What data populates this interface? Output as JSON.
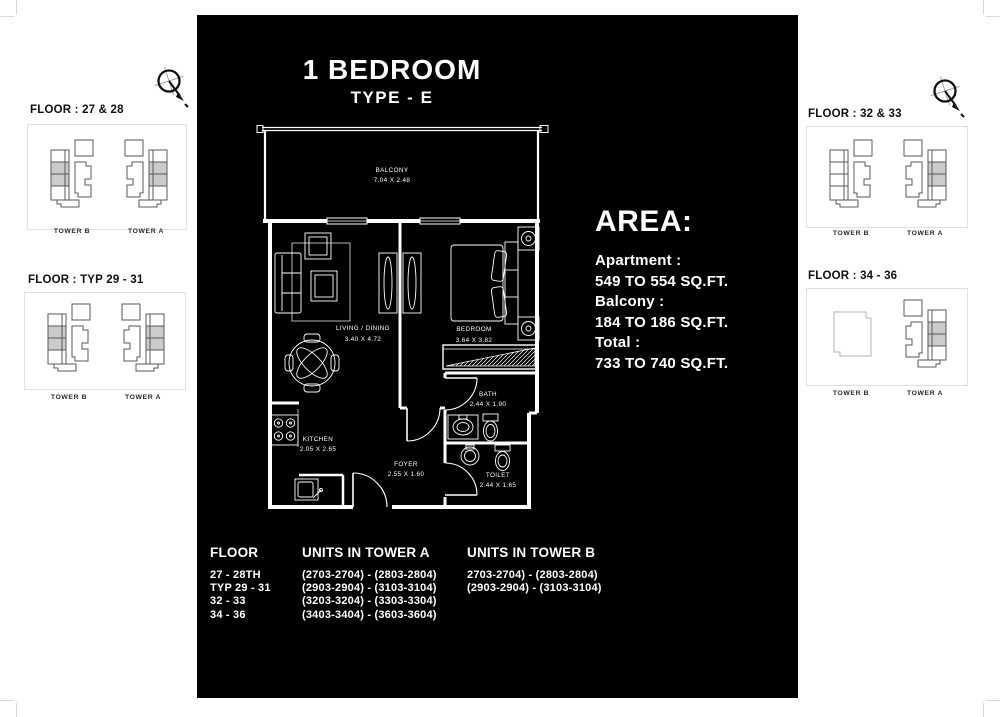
{
  "header": {
    "title": "1 BEDROOM",
    "subtitle": "TYPE - E"
  },
  "area": {
    "heading": "AREA:",
    "apartment_label": "Apartment  :",
    "apartment_value": "549 TO 554 SQ.FT.",
    "balcony_label": "Balcony :",
    "balcony_value": "184 TO 186 SQ.FT.",
    "total_label": "Total :",
    "total_value": "733 TO 740 SQ.FT."
  },
  "floor_plan": {
    "rooms": [
      {
        "name": "BALCONY",
        "dimensions": "7.04 X 2.48"
      },
      {
        "name": "LIVING / DINING",
        "dimensions": "3.40 X 4.72"
      },
      {
        "name": "BEDROOM",
        "dimensions": "3.64 X 3.82"
      },
      {
        "name": "BATH",
        "dimensions": "2.44 X 1.90"
      },
      {
        "name": "KITCHEN",
        "dimensions": "2.05 X 2.65"
      },
      {
        "name": "FOYER",
        "dimensions": "2.55 X 1.60"
      },
      {
        "name": "TOILET",
        "dimensions": "2.44 X 1.65"
      }
    ]
  },
  "key_plans": {
    "left": [
      {
        "floor_label": "FLOOR : 27 & 28",
        "tower_left": "TOWER B",
        "tower_right": "TOWER A"
      },
      {
        "floor_label": "FLOOR : TYP 29 - 31",
        "tower_left": "TOWER B",
        "tower_right": "TOWER A"
      }
    ],
    "right": [
      {
        "floor_label": "FLOOR : 32  & 33",
        "tower_left": "TOWER B",
        "tower_right": "TOWER A"
      },
      {
        "floor_label": "FLOOR : 34 - 36",
        "tower_left": "TOWER B",
        "tower_right": "TOWER A"
      }
    ]
  },
  "units_table": {
    "col_floor_header": "FLOOR",
    "col_tower_a_header": "UNITS IN TOWER A",
    "col_tower_b_header": "UNITS IN TOWER B",
    "floor_rows": [
      "27 - 28TH",
      "TYP 29 - 31",
      "32 - 33",
      "34 - 36"
    ],
    "tower_a_rows": [
      "(2703-2704) - (2803-2804)",
      "(2903-2904) - (3103-3104)",
      "(3203-3204) - (3303-3304)",
      "(3403-3404) - (3603-3604)"
    ],
    "tower_b_rows": [
      "2703-2704) - (2803-2804)",
      "(2903-2904) - (3103-3104)"
    ]
  },
  "colors": {
    "panel_background": "#000000",
    "panel_text": "#ffffff",
    "unit_highlight": "#cbcbcb",
    "keyplan_line": "#5a5a5a"
  }
}
